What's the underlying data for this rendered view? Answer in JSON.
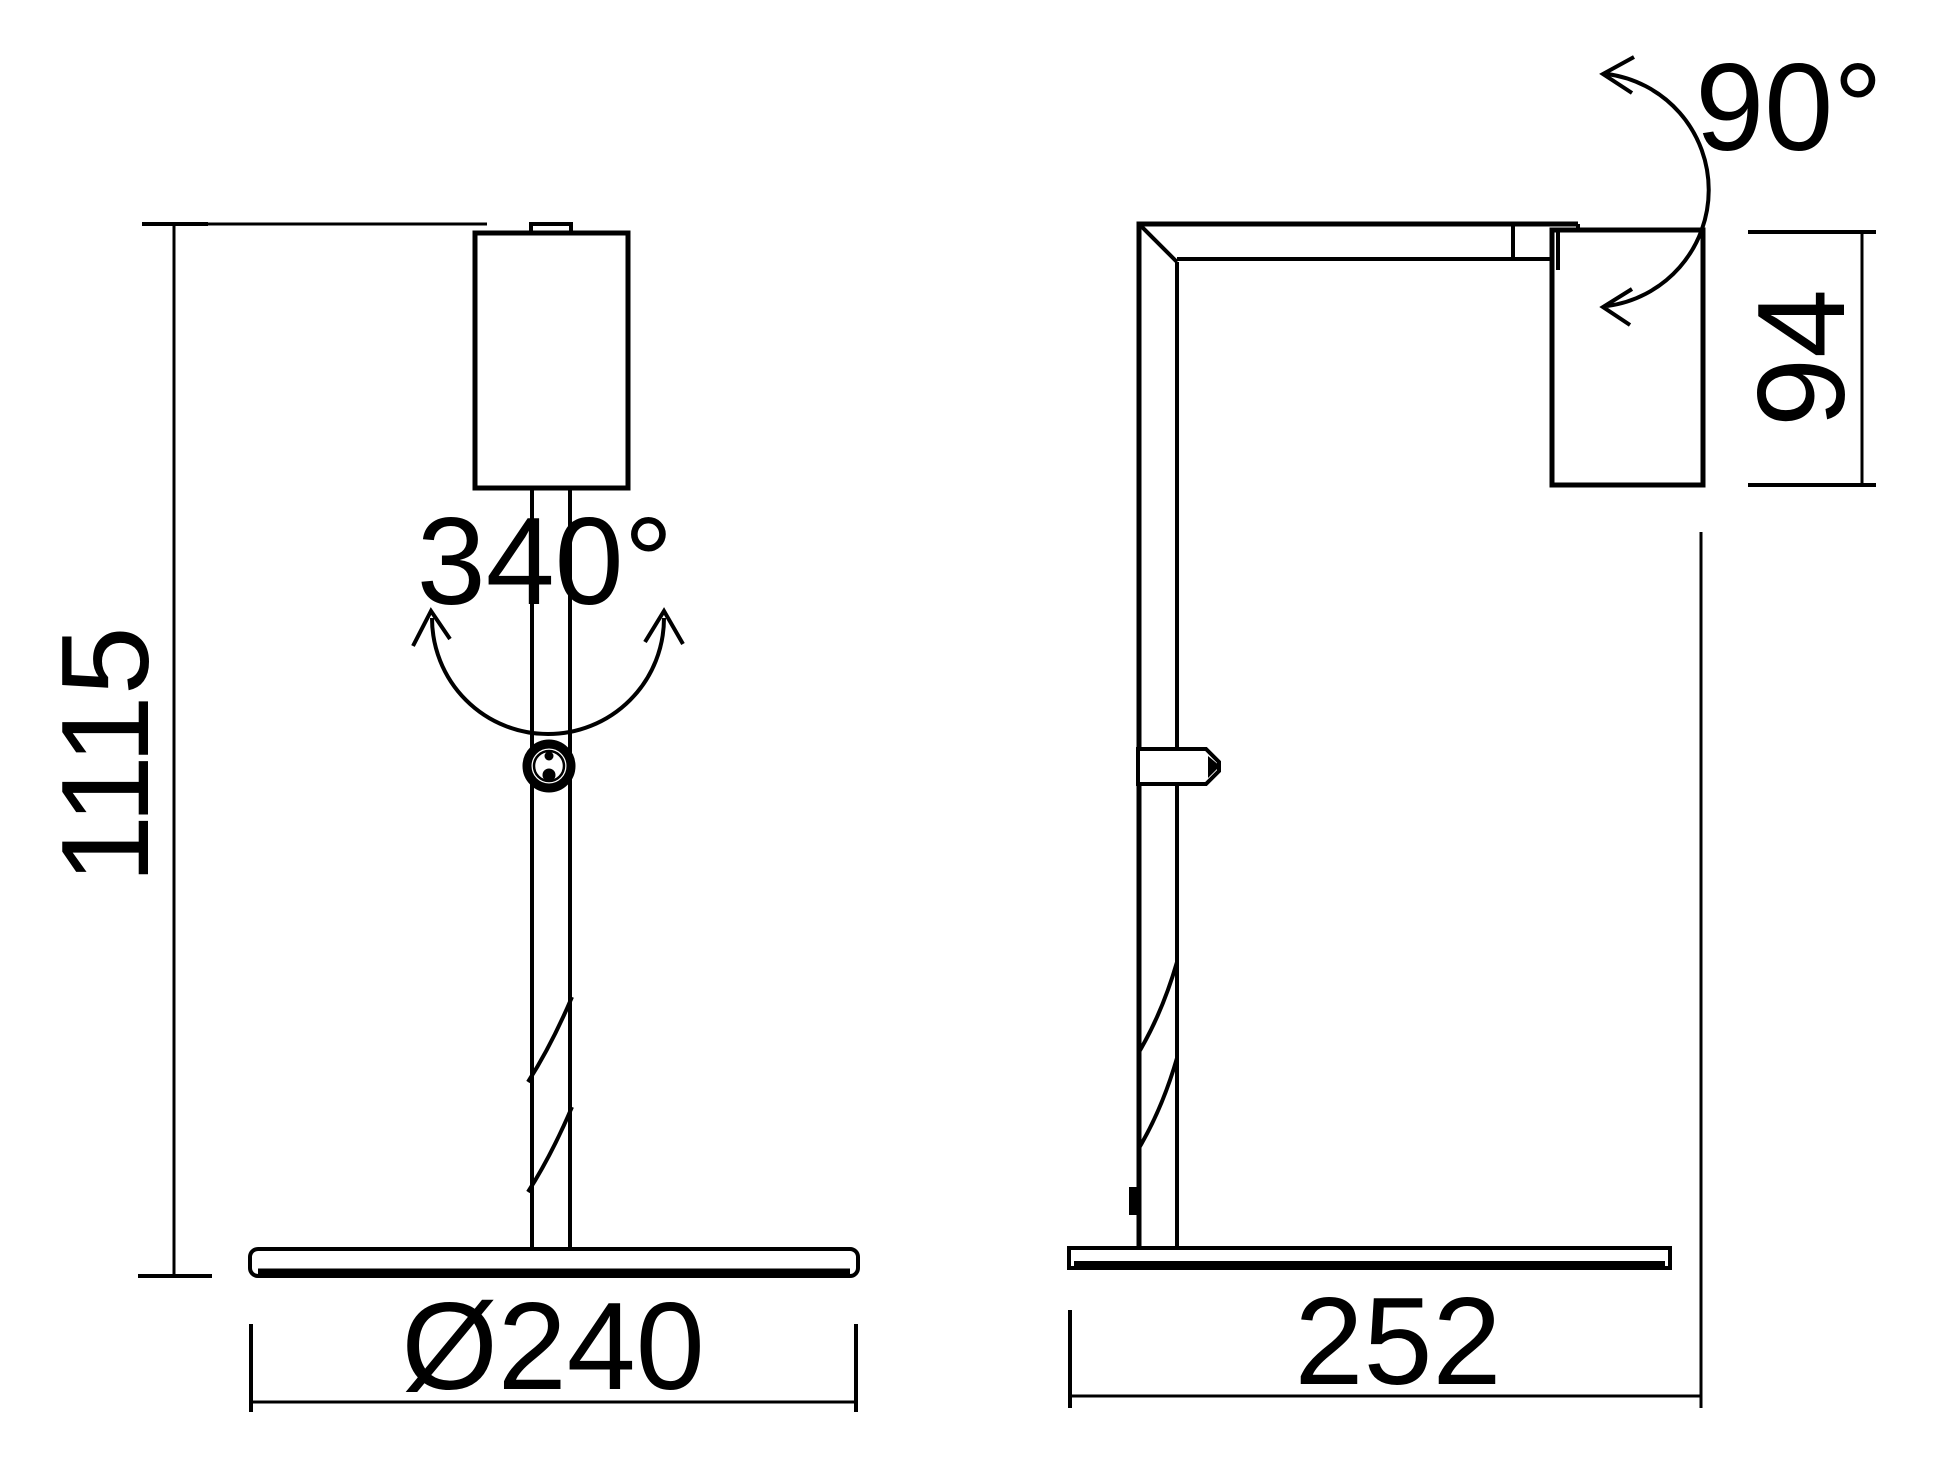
{
  "colors": {
    "background": "#ffffff",
    "line": "#000000"
  },
  "drawing": {
    "front_view": {
      "height_dim_label": "1115",
      "base_diameter_label": "Ø240",
      "swivel_angle_label": "340°"
    },
    "side_view": {
      "base_depth_label": "252",
      "head_height_label": "94",
      "tilt_angle_label": "90°"
    }
  }
}
